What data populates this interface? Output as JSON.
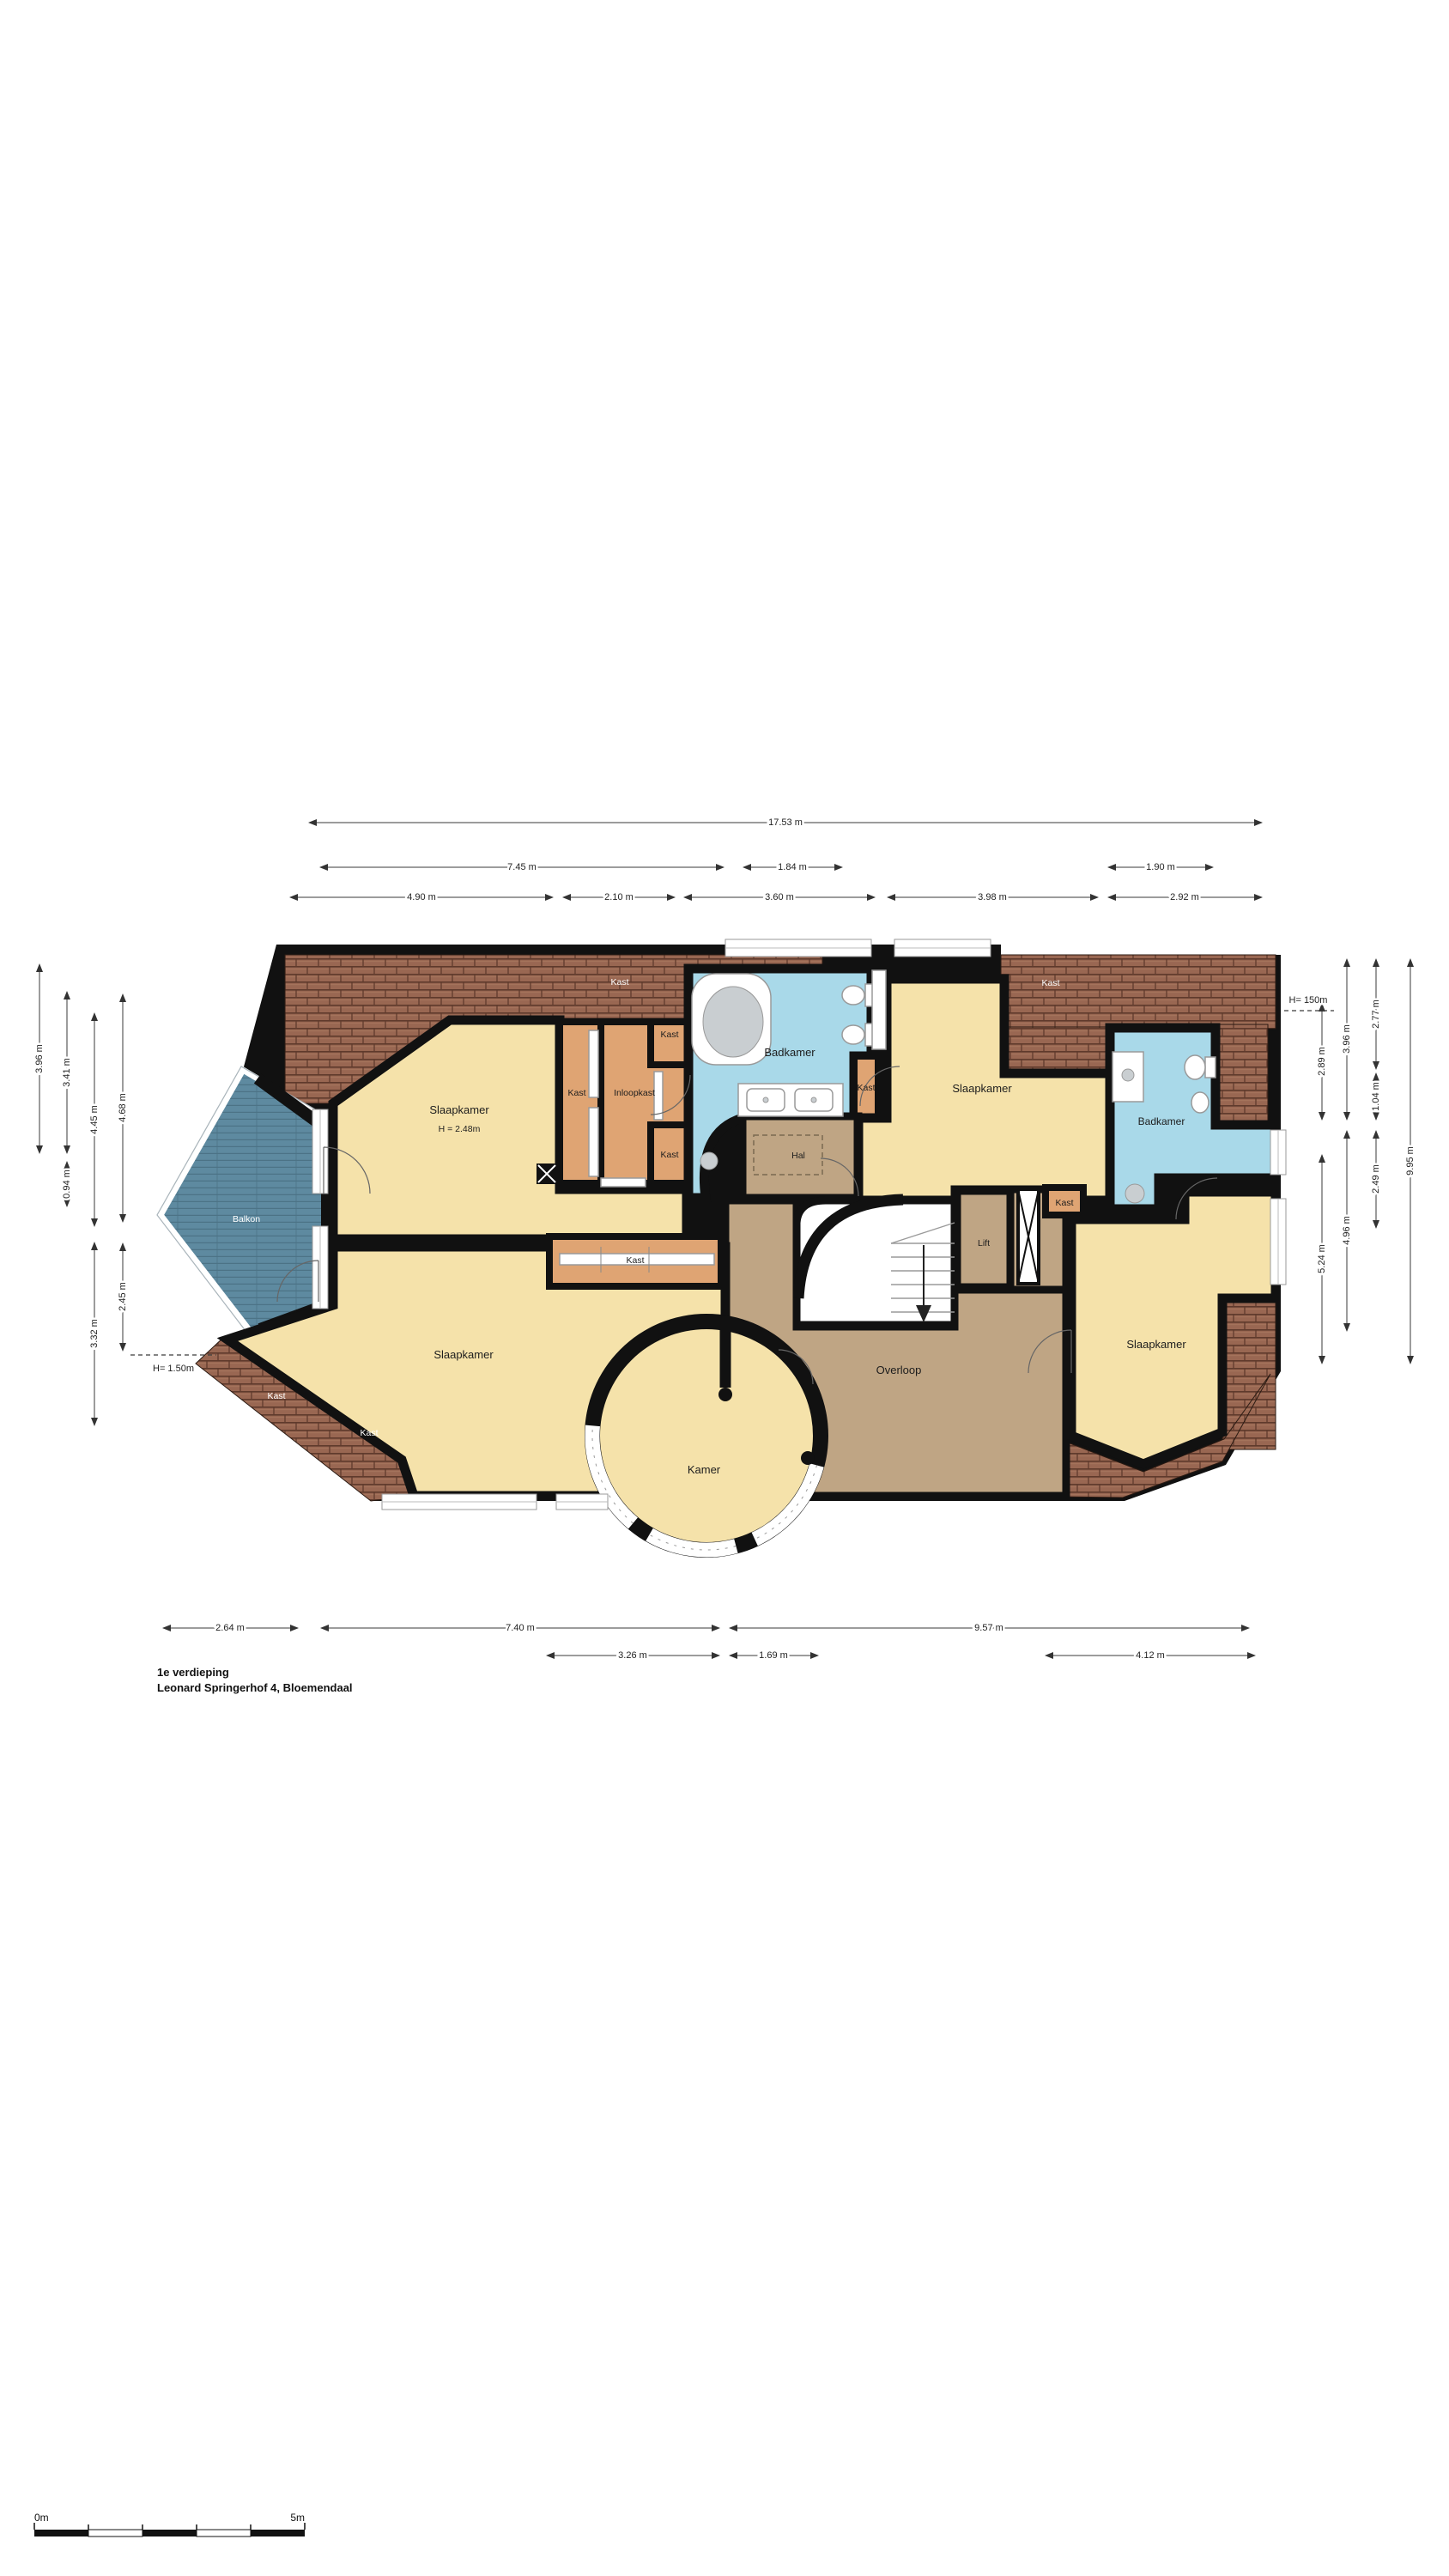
{
  "title": {
    "line1": "1e verdieping",
    "line2": "Leonard Springerhof 4, Bloemendaal"
  },
  "scale_bar": {
    "start_label": "0m",
    "end_label": "5m"
  },
  "colors": {
    "wall": "#111111",
    "room_yellow": "#f5e2aa",
    "closet_orange": "#dfa473",
    "bathroom_blue": "#a9d9e9",
    "hallway_brown": "#bfa584",
    "balcony_deck": "#5e8aa0",
    "roof_brown": "#996752"
  },
  "rooms": {
    "slaapkamer_tl": {
      "name": "Slaapkamer",
      "height": "H = 2.48m"
    },
    "slaapkamer_tr": {
      "name": "Slaapkamer"
    },
    "slaapkamer_bl": {
      "name": "Slaapkamer"
    },
    "slaapkamer_br": {
      "name": "Slaapkamer"
    },
    "badkamer_left": {
      "name": "Badkamer"
    },
    "badkamer_right": {
      "name": "Badkamer"
    },
    "inloopkast": {
      "name": "Inloopkast"
    },
    "kast": {
      "name": "Kast"
    },
    "hal": {
      "name": "Hal"
    },
    "lift": {
      "name": "Lift"
    },
    "overloop": {
      "name": "Overloop"
    },
    "kamer": {
      "name": "Kamer"
    },
    "balkon": {
      "name": "Balkon"
    }
  },
  "dims": {
    "top1": [
      "17.53 m"
    ],
    "top2": [
      "7.45 m",
      "1.84 m",
      "1.90 m"
    ],
    "top3": [
      "4.90 m",
      "2.10 m",
      "3.60 m",
      "3.98 m",
      "2.92 m"
    ],
    "left": [
      "3.96 m",
      "3.41 m",
      "0.94 m",
      "4.45 m",
      "3.32 m",
      "4.68 m",
      "2.45 m"
    ],
    "right": [
      "2.89 m",
      "5.24 m",
      "3.96 m",
      "4.96 m",
      "2.77 m",
      "1.04 m",
      "2.49 m",
      "9.95 m"
    ],
    "bottom1": [
      "2.64 m",
      "7.40 m",
      "9.57 m"
    ],
    "bottom2": [
      "3.26 m",
      "1.69 m",
      "4.12 m"
    ],
    "height_left": "H= 1.50m",
    "height_right": "H= 150m"
  }
}
